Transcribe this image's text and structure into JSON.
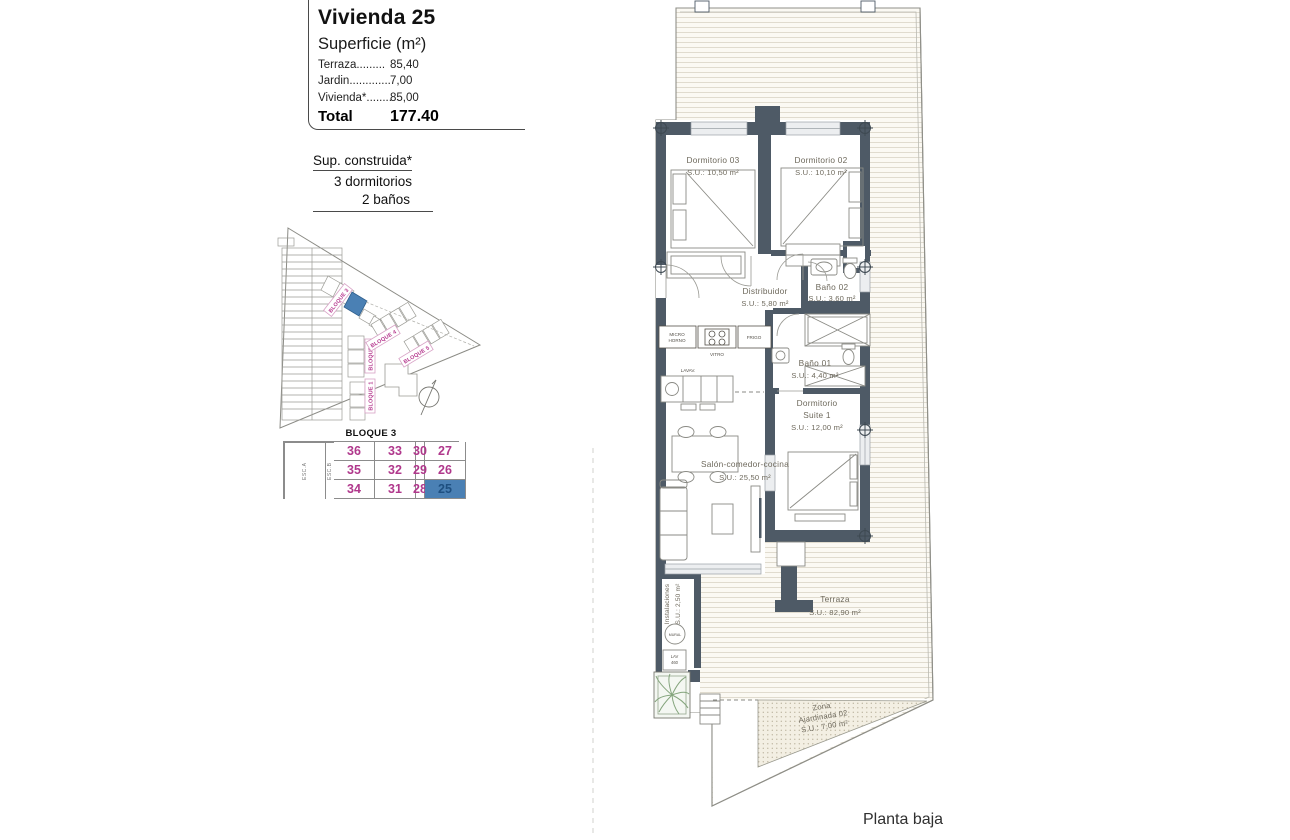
{
  "header": {
    "title": "Vivienda 25",
    "subtitle": "Superficie (m²)",
    "rows": [
      {
        "label": "Terraza.........",
        "value": "85,40"
      },
      {
        "label": "Jardin.............",
        "value": "7,00"
      },
      {
        "label": "Vivienda*........",
        "value": "85,00"
      }
    ],
    "total_label": "Total",
    "total_value": "177.40"
  },
  "supConstruida": {
    "line1": "Sup. construida*",
    "line2": "3 dormitorios",
    "line3": "2 baños"
  },
  "sitePlan": {
    "blocks": [
      "BLOQUE 3",
      "BLOQUE 2",
      "BLOQUE 1",
      "BLOQUE 4",
      "BLOQUE 5"
    ],
    "highlight_color": "#4a80b4"
  },
  "unitTable": {
    "title": "BLOQUE 3",
    "escA": "ESC.A",
    "escB": "ESC.B",
    "rows": [
      [
        "36",
        "33",
        "30",
        "27"
      ],
      [
        "35",
        "32",
        "29",
        "26"
      ],
      [
        "34",
        "31",
        "28",
        "25"
      ]
    ],
    "highlight_unit": "25",
    "number_color": "#b0388c",
    "highlight_bg": "#4a80b4"
  },
  "floorPlan": {
    "rooms": {
      "dorm03": {
        "name": "Dormitorio 03",
        "area": "S.U.: 10,50 m²"
      },
      "dorm02": {
        "name": "Dormitorio 02",
        "area": "S.U.: 10,10 m²"
      },
      "distribuidor": {
        "name": "Distribuidor",
        "area": "S.U.: 5,80 m²"
      },
      "bano02": {
        "name": "Baño 02",
        "area": "S.U.: 3,60 m²"
      },
      "bano01": {
        "name": "Baño 01",
        "area": "S.U.: 4,40 m²"
      },
      "suite": {
        "line1": "Dormitorio",
        "line2": "Suite 1",
        "area": "S.U.: 12,00 m²"
      },
      "salon": {
        "name": "Salón-comedor-cocina",
        "area": "S.U.: 25,50 m²"
      },
      "terraza": {
        "name": "Terraza",
        "area": "S.U.: 82,90 m²"
      },
      "instalaciones": {
        "name": "Instalaciones",
        "area": "S.U.: 2,50 m²"
      },
      "jardin": {
        "line1": "Zona",
        "line2": "Ajardinada 02",
        "area": "S.U.: 7,00 m²"
      }
    },
    "appliances": {
      "micro_line1": "MICRO",
      "micro_line2": "HORNO",
      "vitro": "VITRO",
      "frigo": "FRIGO",
      "lavav": "LAVAV.",
      "mural": "MURAL",
      "lav_line1": "LAV",
      "lav_line2": "460"
    },
    "caption": "Planta baja"
  },
  "colors": {
    "wall": "#4e5a66",
    "accent_pink": "#b0388c",
    "highlight_blue": "#4a80b4"
  }
}
